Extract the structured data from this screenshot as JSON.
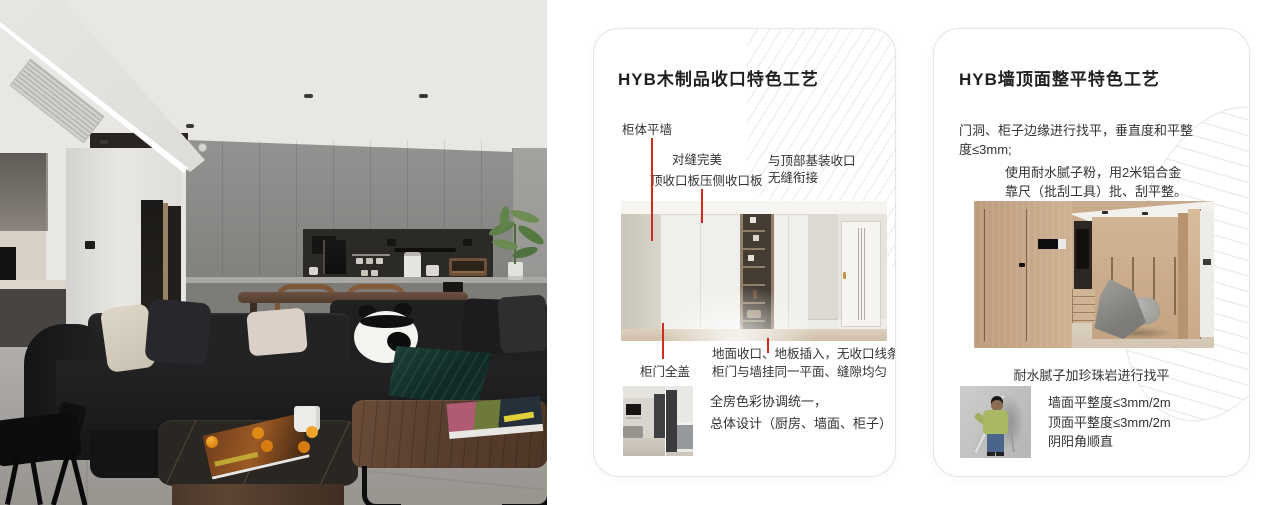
{
  "colors": {
    "accent_red": "#cf2b1e",
    "card_border": "#e5e5e5",
    "deco_line": "#eaeaea",
    "page_bg": "#ffffff"
  },
  "card_wood": {
    "title": "HYB木制品收口特色工艺",
    "callouts": {
      "cabinet_flush": "柜体平墙",
      "seam_perfect": "对缝完美",
      "top_board": "顶收口板压侧收口板",
      "ceiling_joint": [
        "与顶部基装收口",
        "无缝衔接"
      ],
      "door_full_cover": "柜门全盖",
      "floor_joint": [
        "地面收口、地板插入，无收口线条",
        "柜门与墙挂同一平面、缝隙均匀"
      ]
    },
    "summary": [
      "全房色彩协调统一，",
      "总体设计（厨房、墙面、柜子）"
    ]
  },
  "card_wall": {
    "title": "HYB墙顶面整平特色工艺",
    "para1": [
      "门洞、柜子边缘进行找平，垂直度和平整",
      "度≤3mm;"
    ],
    "para2": [
      "使用耐水腻子粉，用2米铝合金",
      "靠尺（批刮工具）批、刮平整。"
    ],
    "caption": "耐水腻子加珍珠岩进行找平",
    "specs": [
      "墙面平整度≤3mm/2m",
      "顶面平整度≤3mm/2m",
      "阴阳角顺直"
    ]
  }
}
